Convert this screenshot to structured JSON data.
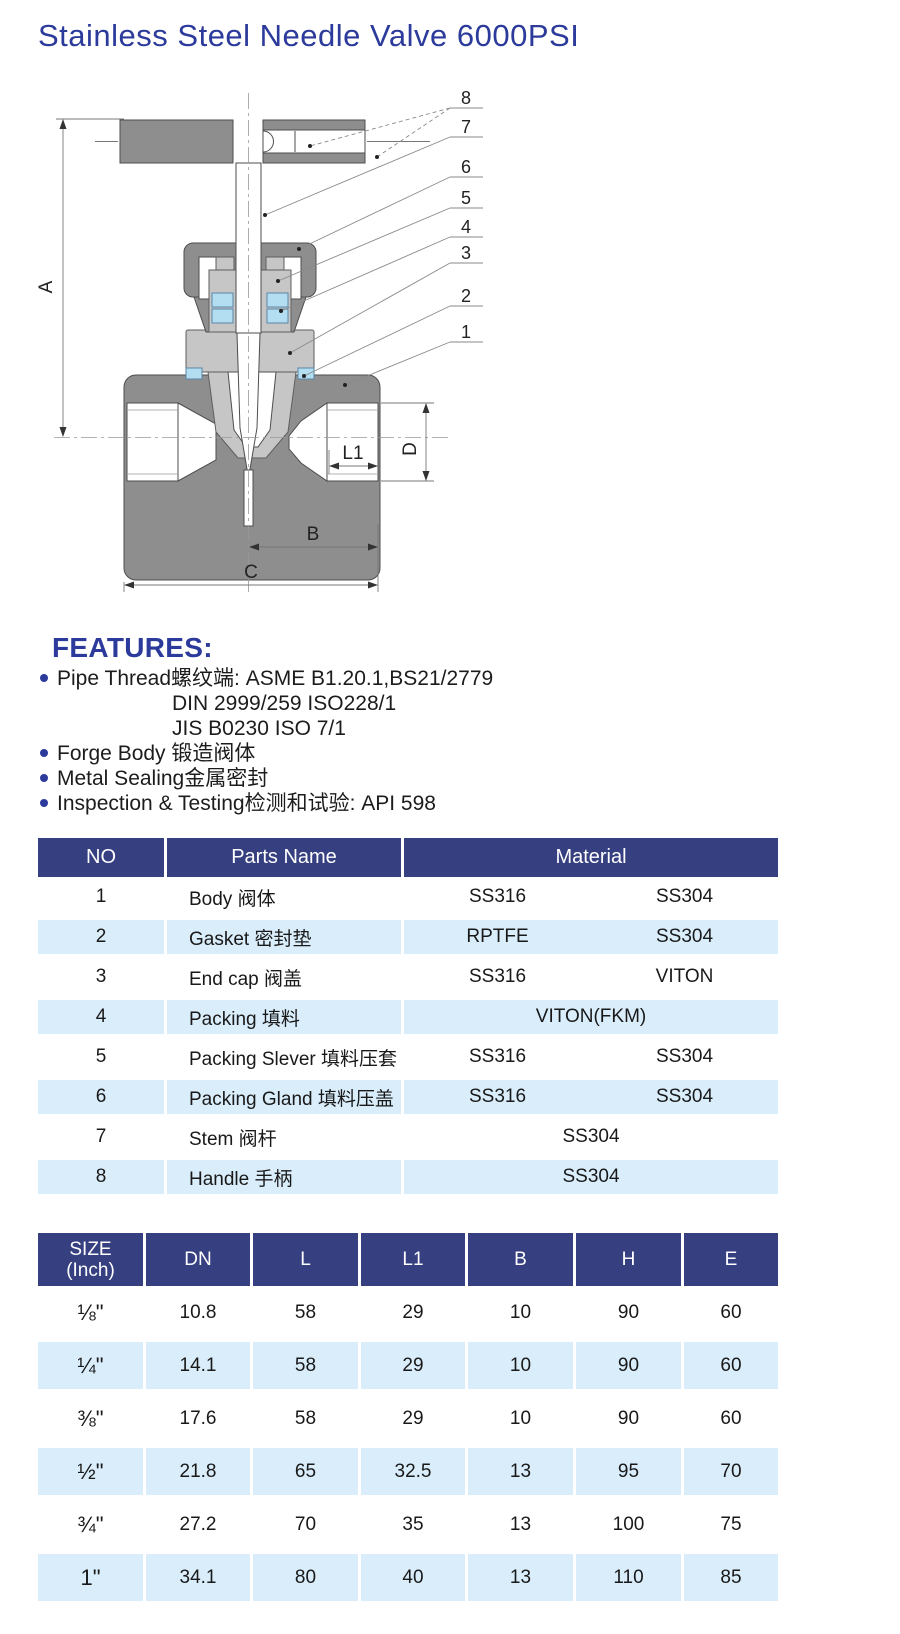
{
  "page": {
    "title": "Stainless Steel Needle Valve 6000PSI"
  },
  "colors": {
    "table_header_navy": "#363f80",
    "row_highlight_blue": "#d9edfb",
    "accent_navy": "#2b3a9b"
  },
  "diagram": {
    "callouts": [
      "1",
      "2",
      "3",
      "4",
      "5",
      "6",
      "7",
      "8"
    ],
    "dims": {
      "a": "A",
      "b": "B",
      "c": "C",
      "d": "D",
      "l1": "L1"
    }
  },
  "features": {
    "heading": "FEATURES:",
    "items": [
      {
        "text": "Pipe Thread螺纹端: ASME B1.20.1,BS21/2779",
        "sub": [
          "DIN 2999/259 ISO228/1",
          "JIS B0230 ISO 7/1"
        ]
      },
      {
        "text": "Forge Body 锻造阀体"
      },
      {
        "text": "Metal Sealing金属密封"
      },
      {
        "text": "Inspection & Testing检测和试验: API 598"
      }
    ]
  },
  "parts_table": {
    "headers": {
      "no": "NO",
      "name": "Parts Name",
      "material": "Material"
    },
    "rows": [
      {
        "no": "1",
        "name": "Body 阀体",
        "m1": "SS316",
        "m2": "SS304"
      },
      {
        "no": "2",
        "name": "Gasket 密封垫",
        "m1": "RPTFE",
        "m2": "SS304"
      },
      {
        "no": "3",
        "name": "End cap 阀盖",
        "m1": "SS316",
        "m2": "VITON"
      },
      {
        "no": "4",
        "name": "Packing 填料",
        "m1": "VITON(FKM)"
      },
      {
        "no": "5",
        "name": "Packing Slever 填料压套",
        "m1": "SS316",
        "m2": "SS304"
      },
      {
        "no": "6",
        "name": "Packing Gland 填料压盖",
        "m1": "SS316",
        "m2": "SS304"
      },
      {
        "no": "7",
        "name": "Stem 阀杆",
        "m1": "SS304"
      },
      {
        "no": "8",
        "name": "Handle 手柄",
        "m1": "SS304"
      }
    ]
  },
  "size_table": {
    "headers": {
      "size1": "SIZE",
      "size2": "(Inch)",
      "dn": "DN",
      "l": "L",
      "l1": "L1",
      "b": "B",
      "h": "H",
      "e": "E"
    },
    "rows": [
      [
        "⅛\"",
        "10.8",
        "58",
        "29",
        "10",
        "90",
        "60"
      ],
      [
        "¼\"",
        "14.1",
        "58",
        "29",
        "10",
        "90",
        "60"
      ],
      [
        "⅜\"",
        "17.6",
        "58",
        "29",
        "10",
        "90",
        "60"
      ],
      [
        "½\"",
        "21.8",
        "65",
        "32.5",
        "13",
        "95",
        "70"
      ],
      [
        "¾\"",
        "27.2",
        "70",
        "35",
        "13",
        "100",
        "75"
      ],
      [
        "1\"",
        "34.1",
        "80",
        "40",
        "13",
        "110",
        "85"
      ]
    ]
  }
}
